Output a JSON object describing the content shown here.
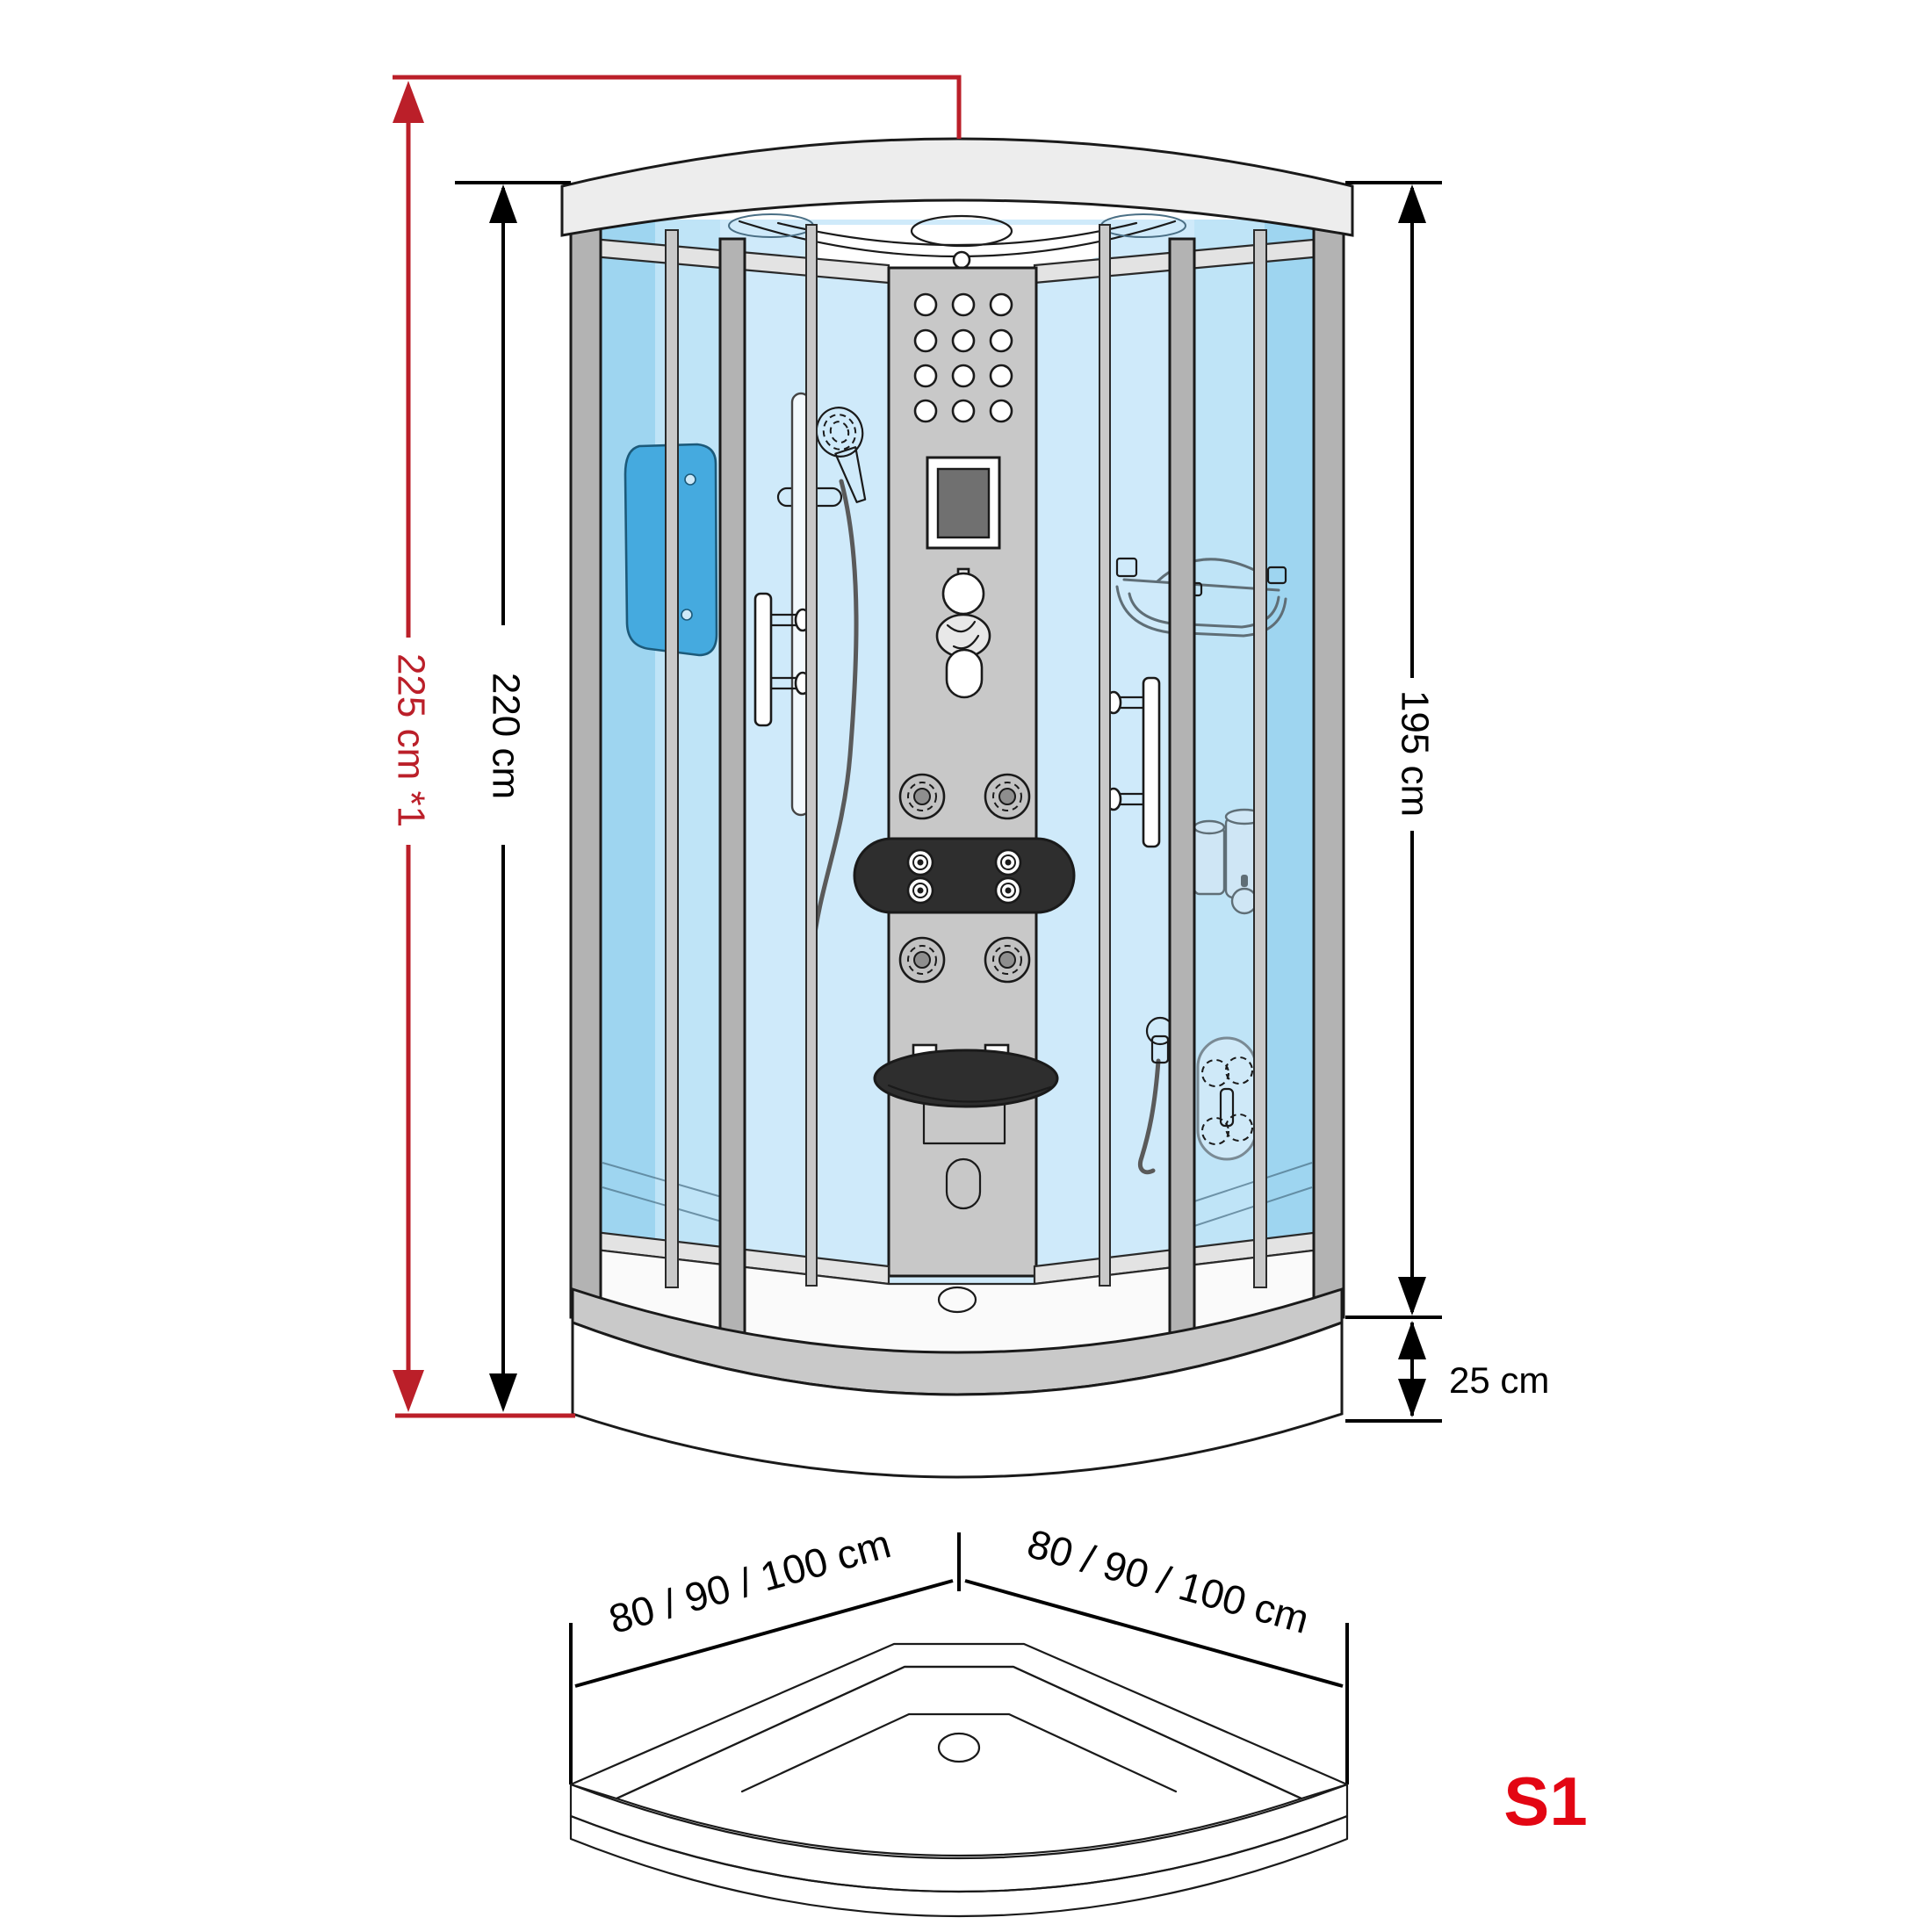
{
  "diagram": {
    "type": "product-dimension-drawing",
    "subject": "quarter-circle steam shower cabin, front view with separate shower tray view",
    "annotations": {
      "total_height": "225 cm *1",
      "cabin_height": "220 cm",
      "inner_height": "195 cm",
      "tray_height": "25 cm",
      "base_width_left": "80 / 90 / 100 cm",
      "base_width_right": "80 / 90 / 100 cm",
      "model": "S1"
    },
    "colors": {
      "dimension_red": "#bb1f29",
      "model_red": "#e30613",
      "outline_black": "#1a1a1a",
      "frame_gray": "#b3b3b3",
      "roof_gray": "#ededed",
      "glass_light": "#cfeafa",
      "glass_mid": "#a9d9f2",
      "glass_deep": "#8fcdee",
      "seat_panel_blue": "#45aadf",
      "tray_gray": "#c9c9c9",
      "dark_fixture": "#2e2e2e"
    }
  }
}
